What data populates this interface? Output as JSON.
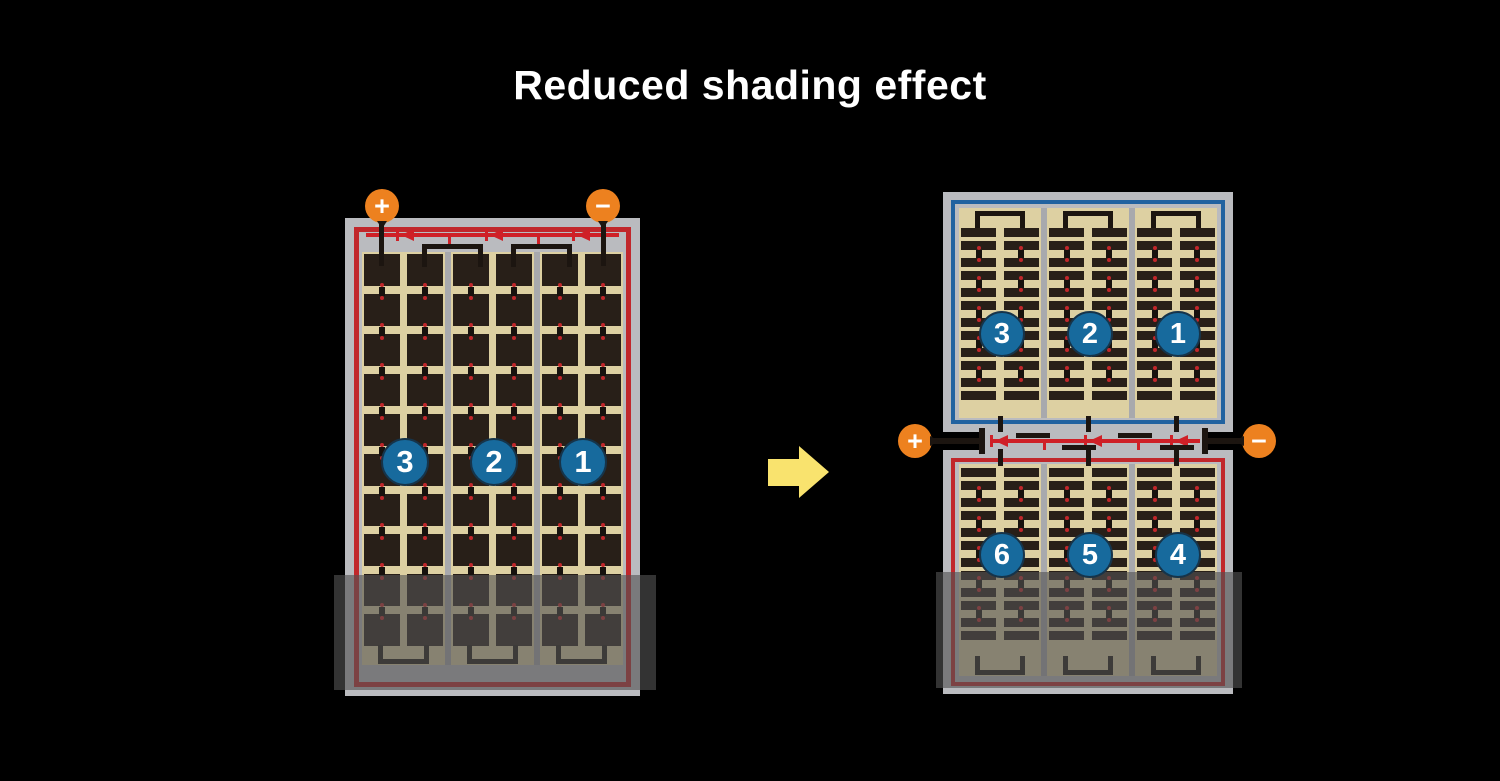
{
  "title": "Reduced shading effect",
  "terminals": {
    "plus": "+",
    "minus": "−"
  },
  "panels": {
    "left": {
      "description": "full-cell panel",
      "cell_type": "full",
      "strings": 3,
      "rows": 10,
      "labels": [
        "3",
        "2",
        "1"
      ],
      "border": "red",
      "bridge": "bottom",
      "diode_count": 3,
      "shaded": true
    },
    "right_top": {
      "description": "half-cut panel upper half",
      "cell_type": "half",
      "strings": 3,
      "row_groups": 6,
      "labels": [
        "3",
        "2",
        "1"
      ],
      "border": "blue",
      "bridge": "top",
      "shaded": false
    },
    "right_bottom": {
      "description": "half-cut panel lower half",
      "cell_type": "half",
      "strings": 3,
      "row_groups": 6,
      "labels": [
        "6",
        "5",
        "4"
      ],
      "border": "red",
      "bridge": "bottom",
      "shaded": true
    }
  },
  "junction": {
    "diode_count": 3
  },
  "colors": {
    "background": "#000000",
    "title_text": "#ffffff",
    "frame_gray": "#babbbf",
    "separator_gray": "#a8a9ad",
    "cell_area_tan": "#ddd0a2",
    "cell_dark": "#281f18",
    "wire_black": "#1c1510",
    "red_border": "#c1272b",
    "blue_border": "#2162a0",
    "diode_red": "#cf2027",
    "terminal_orange": "#ed811f",
    "badge_blue": "#176a9d",
    "badge_rim_navy": "#16344a",
    "solder_dot_red": "#c1272b",
    "arrow_yellow": "#f9e36e",
    "shade_overlay": "rgba(82,82,82,0.62)"
  }
}
